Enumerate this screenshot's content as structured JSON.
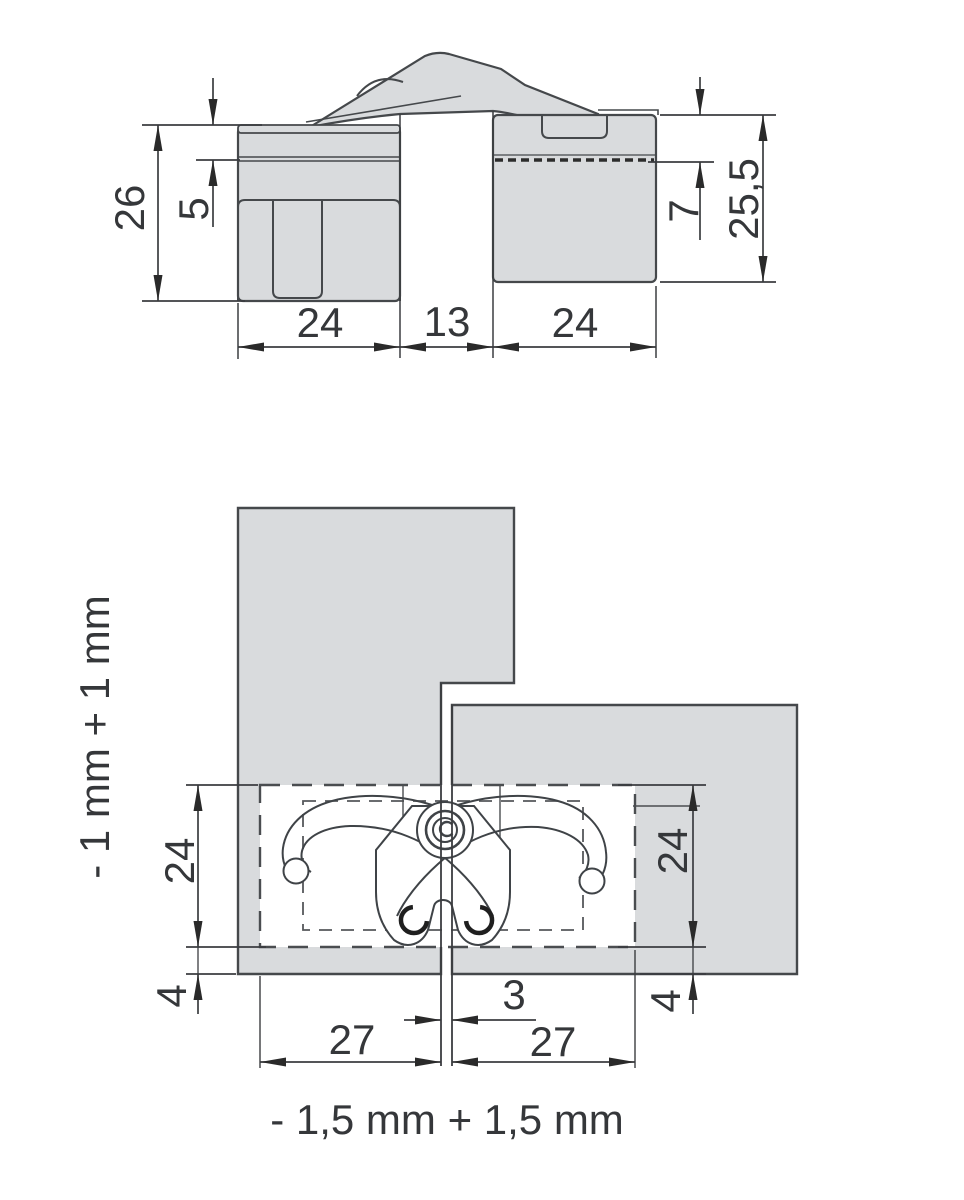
{
  "colors": {
    "background": "#ffffff",
    "panel_fill": "#d9dbdd",
    "outline": "#45484b",
    "dim_line": "#3b3d40",
    "arrow_fill": "#2a2a2a",
    "label_text": "#35373a"
  },
  "top_view": {
    "dims": {
      "left_height": "26",
      "cap_depth": "5",
      "left_width": "24",
      "gap_width": "13",
      "right_width": "24",
      "right_inset": "7",
      "right_height": "25,5"
    }
  },
  "bottom_view": {
    "dims": {
      "cutout_height_left": "24",
      "cutout_height_right": "24",
      "edge_offset_left": "4",
      "edge_offset_right": "4",
      "door_gap": "3",
      "cutout_width_left": "27",
      "cutout_width_right": "27"
    },
    "adjustment_vertical": "- 1 mm + 1 mm",
    "adjustment_horizontal": "- 1,5 mm + 1,5 mm"
  }
}
